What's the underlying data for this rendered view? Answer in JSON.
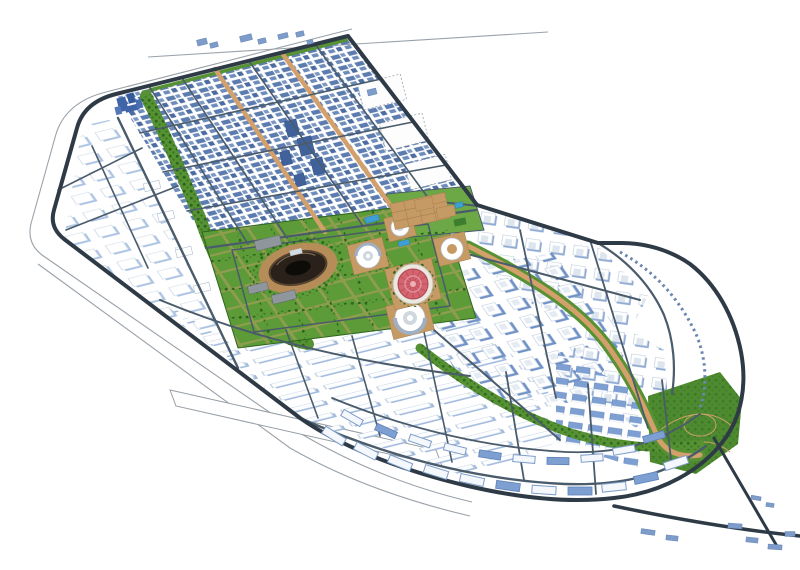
{
  "meta": {
    "description": "Aerial 3D architectural rendering of a planned city master plan on a white background",
    "view": "isometric bird's-eye visualization, no visible text or UI chrome"
  },
  "palette": {
    "background": "#ffffff",
    "road_dark": "#2e3b47",
    "road_minor": "#4a5b6b",
    "boundary_light": "#9aa2aa",
    "green": "#569133",
    "green_light": "#6ca845",
    "tree_dots": "#2c661d",
    "tan_boulevard": "#d3a06b",
    "plaza_tan": "#c59a64",
    "building_blue": "#5c7cb0",
    "building_white": "#ffffff",
    "pool_blue": "#3f9fd4",
    "dome_red": "#d4646f",
    "stadium_dark": "#26201a"
  },
  "districts": [
    {
      "name": "upper-dense-district",
      "description": "dense grid of blue-shaded mid-rise blocks with tan streets and green edge strip"
    },
    {
      "name": "west-lowrise-district",
      "description": "flat white low-rise parcels inside the western perimeter"
    },
    {
      "name": "central-park",
      "description": "green civic park with circular landmark buildings, plazas and tree rows"
    },
    {
      "name": "northeast-residential-rows",
      "description": "rows of white U-shaped housing blocks crossed by a tan boulevard"
    },
    {
      "name": "city-center-towers",
      "description": "cluster of tall white towers with strong blue shading"
    },
    {
      "name": "southern-industrial-rows",
      "description": "long white slab buildings in parallel rows"
    },
    {
      "name": "southeast-blueroof-cluster",
      "description": "blue-roofed blocks near the southeast corner"
    },
    {
      "name": "bottom-arc-rows",
      "description": "arcs of slab buildings following the curved southern perimeter"
    },
    {
      "name": "southeast-park",
      "description": "green park wedge with looping paths at the southeast corner"
    }
  ],
  "landmarks": [
    {
      "name": "red-ribbed-dome",
      "color": "#d4646f"
    },
    {
      "name": "dark-oval-stadium",
      "color": "#26201a"
    },
    {
      "name": "spiral-round-building-a"
    },
    {
      "name": "spiral-round-building-b"
    },
    {
      "name": "spiral-round-building-c"
    },
    {
      "name": "round-courtyard-building"
    },
    {
      "name": "blue-sculptural-cluster",
      "color": "#3f64a8"
    },
    {
      "name": "swimming-pools",
      "color": "#3f9fd4"
    }
  ],
  "roads": {
    "perimeter": "dark ring road around the whole site",
    "outer_boundary": "thin light survey lines outside the perimeter",
    "tan_boulevards": "orange pedestrian boulevards through the grids",
    "bottom_highway": "dark highway leaving the site at bottom right"
  }
}
